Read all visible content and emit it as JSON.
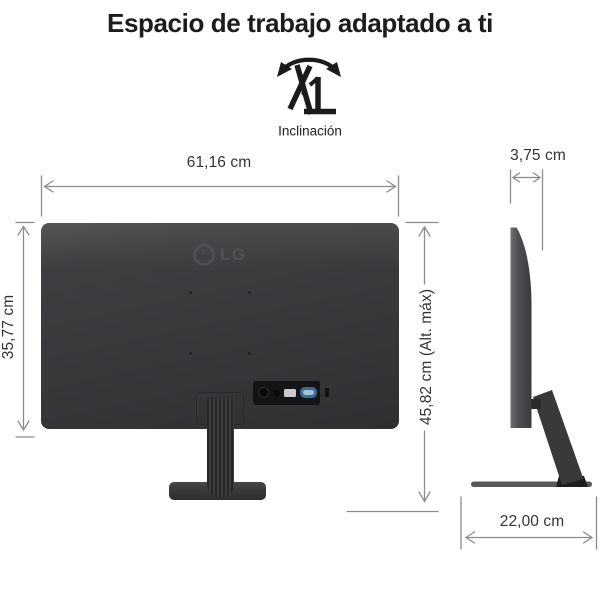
{
  "title": "Espacio de trabajo adaptado a ti",
  "feature": {
    "label": "Inclinación",
    "icon": "tilt-icon"
  },
  "rear_view": {
    "logo_text": "LG",
    "width": "61,16 cm",
    "height": "35,77 cm",
    "max_height": "45,82 cm (Alt. máx)"
  },
  "side_view": {
    "depth": "3,75 cm",
    "base_depth": "22,00 cm"
  },
  "colors": {
    "monitor_body": "#3a3a3d",
    "stand_dark": "#28282a",
    "vga_port_blue": "#3c6c9d",
    "hdmi_port_gray": "#c9c9cd",
    "dimension_line": "#8c8c8c",
    "dimension_text": "#333437",
    "title_text": "#1c1c1e",
    "background": "#ffffff"
  }
}
